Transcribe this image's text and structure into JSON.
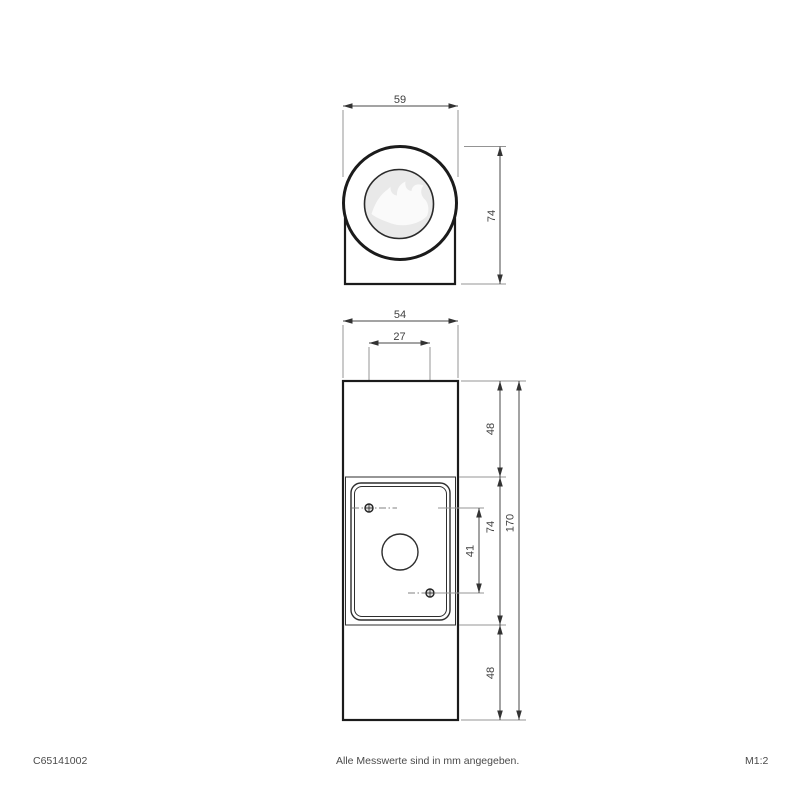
{
  "drawing": {
    "top_view": {
      "head_diameter": "59",
      "head_depth": "74"
    },
    "front_view": {
      "body_width": "54",
      "hole_spacing_horizontal": "27",
      "top_section_height": "48",
      "plate_height": "74",
      "hole_spacing_vertical": "41",
      "bottom_section_height": "48",
      "total_height": "170"
    }
  },
  "footer": {
    "article_number": "C65141002",
    "note": "Alle Messwerte sind in mm angegeben.",
    "scale": "M1:2"
  },
  "colors": {
    "background": "#ffffff",
    "outline": "#1b1b1b",
    "dimension_line": "#474747",
    "extension_line": "#949494",
    "dimension_text": "#3f3f3f",
    "footer_text": "#4a4a4a",
    "lens_fill": "#e9e9e9",
    "swirl_fill": "#fafafa"
  }
}
